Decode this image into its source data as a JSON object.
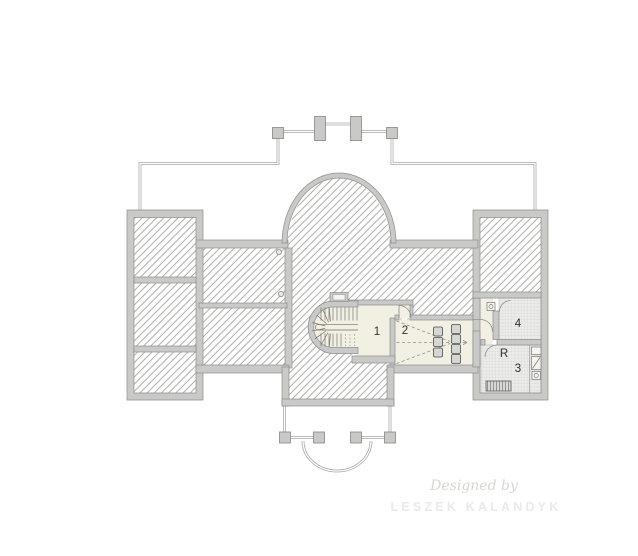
{
  "room_labels": {
    "room1": "1",
    "room2": "2",
    "room3": "3",
    "room4": "4",
    "roomR": "R"
  },
  "watermark": {
    "line1": "Designed by",
    "line2": "LESZEK KALANDYK"
  },
  "colors": {
    "background": "#ffffff",
    "wall_fill": "#c9c9c7",
    "wall_edge": "#8e8e8c",
    "hatch_line": "#a0a09e",
    "thin_wall": "#a6a6a4",
    "room_fill": "#f2efe3",
    "tile_fill": "#ececea",
    "tile_line": "#c9c9c7",
    "label_text": "#2f2f2d",
    "watermark_script": "#d9d6d1",
    "watermark_caps": "#eceae6"
  }
}
